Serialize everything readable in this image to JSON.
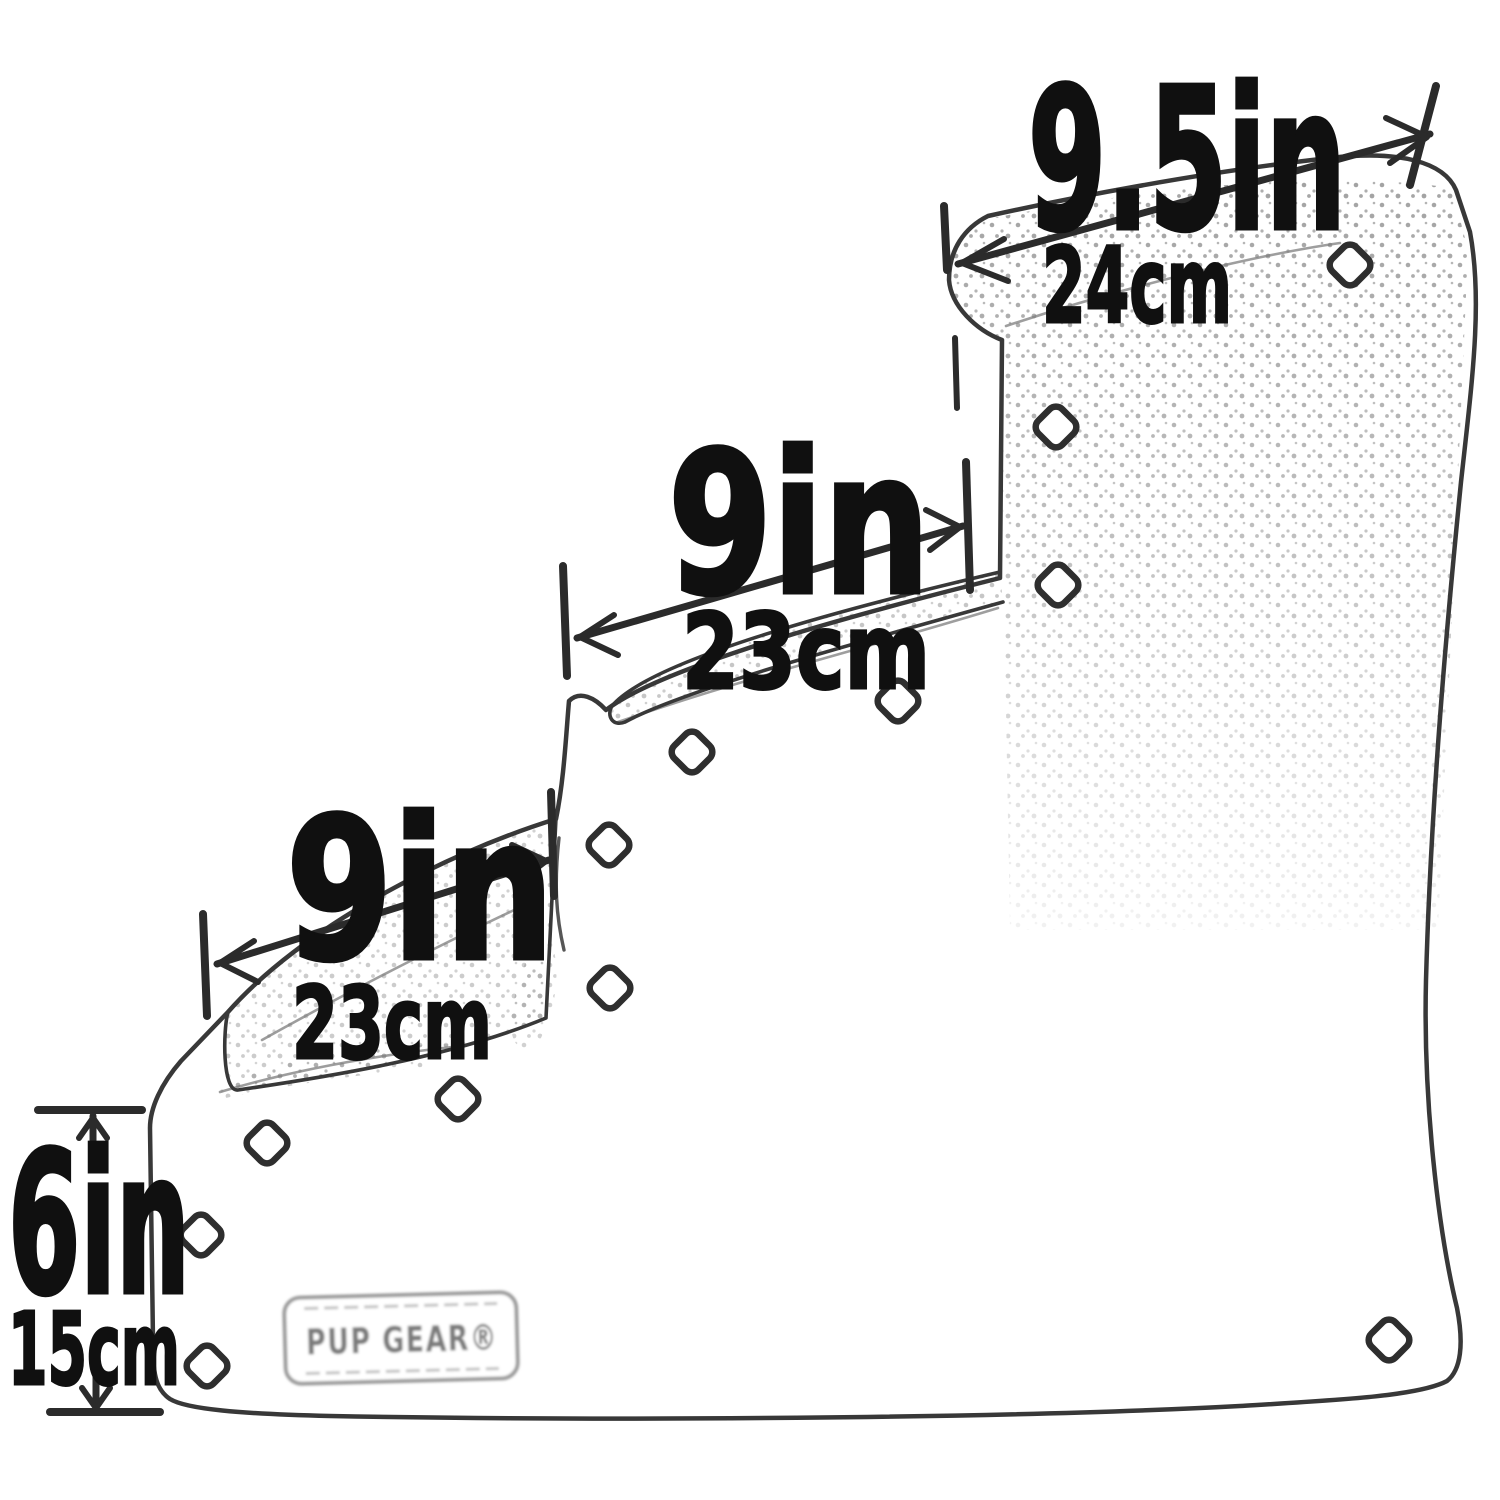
{
  "page": {
    "title": "Pet stairs dimension diagram",
    "background": "#ffffff"
  },
  "diagram": {
    "type": "product-dimension-line-drawing",
    "subject": "Four-step pet stairs side profile with diamond-shaped cutouts and stippled tread texture",
    "ink_color": "#2e2e2e",
    "label_color": "#101010",
    "light_line_color": "#8a8a8a"
  },
  "dimensions": [
    {
      "id": "top-step-depth",
      "inches": "9.5in",
      "metric": "24cm"
    },
    {
      "id": "middle-step-depth",
      "inches": "9in",
      "metric": "23cm"
    },
    {
      "id": "lower-step-depth",
      "inches": "9in",
      "metric": "23cm"
    },
    {
      "id": "bottom-step-height",
      "inches": "6in",
      "metric": "15cm"
    }
  ],
  "brand": {
    "label": "PUP GEAR®"
  }
}
